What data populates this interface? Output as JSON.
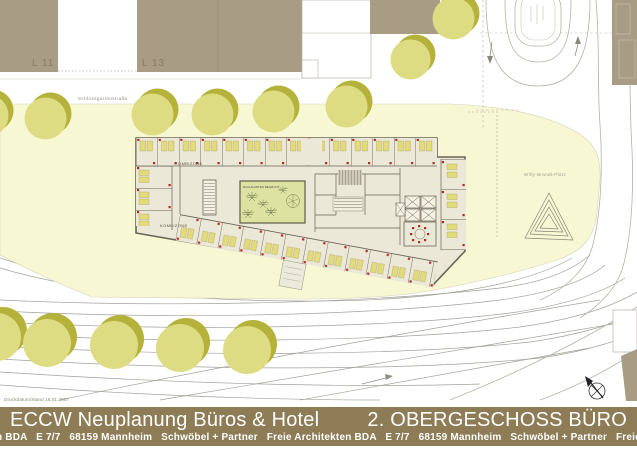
{
  "header": {
    "print_info": "Druckdatum/Stand 16.01.2007"
  },
  "title_bar": {
    "project_title": "ECCW Neuplanung Büros & Hotel",
    "floor_title": "2. OBERGESCHOSS BÜRO",
    "address_ticker": "n BDA   E 7/7   68159 Mannheim   Schwöbel + Partner   Freie Architekten BDA   E 7/7   68159 Mannheim   Schwöbel + Partner   Freie Archite"
  },
  "site": {
    "street_label": "Schlossgartenstraße",
    "plaza_label": "Willy-Brandt-Platz",
    "block_l11": "L 11",
    "block_l13": "L 13"
  },
  "plan": {
    "zone_label_upper": "KOMBIZONE",
    "zone_label_lower": "KOMBIZONE",
    "courtyard_label": "DACHGARTEN BEGRÜNT"
  },
  "colors": {
    "plaza": "#f8f7d4",
    "treeLight": "#dedc82",
    "treeDark": "#b5b23c",
    "blockBrown": "#a89c85",
    "planFill": "#ebe8d8",
    "wall": "#6b6353",
    "desk": "#e3da7a",
    "doorRed": "#b52a20",
    "courtyard": "#dde2a3",
    "barBrown": "#8d7c55",
    "track": "#a3a199",
    "roadLine": "#b5b2a6",
    "labelGray": "#979282"
  }
}
